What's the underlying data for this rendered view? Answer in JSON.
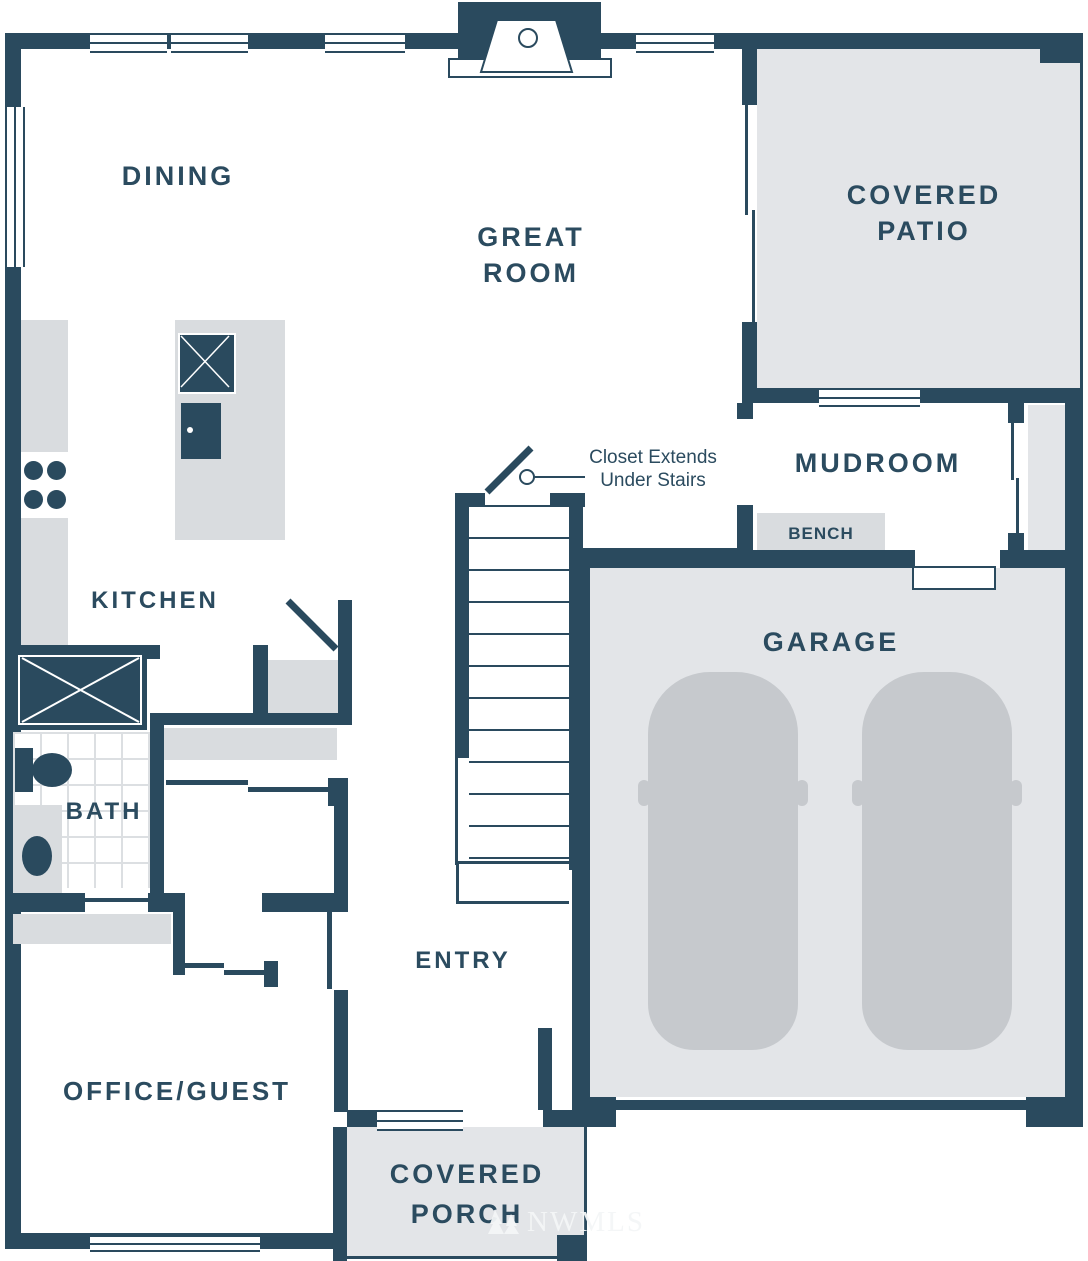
{
  "plan": {
    "rooms": {
      "dining": "DINING",
      "great_room_line1": "GREAT",
      "great_room_line2": "ROOM",
      "covered_patio_line1": "COVERED",
      "covered_patio_line2": "PATIO",
      "mudroom": "MUDROOM",
      "bench": "BENCH",
      "garage": "GARAGE",
      "kitchen": "KITCHEN",
      "bath": "BATH",
      "entry": "ENTRY",
      "office_guest": "OFFICE/GUEST",
      "covered_porch_line1": "COVERED",
      "covered_porch_line2": "PORCH"
    },
    "annotations": {
      "closet_line1": "Closet Extends",
      "closet_line2": "Under Stairs"
    },
    "watermark": "NWMLS",
    "colors": {
      "wall": "#2A4A5E",
      "floor_gray": "#E3E5E8",
      "counter_gray": "#D9DCDF",
      "car_gray": "#C6C9CD",
      "tile_line": "#DCDFE2"
    },
    "fixtures": [
      "fireplace",
      "window",
      "sliding-glass-door",
      "kitchen-island",
      "island-sink",
      "dishwasher",
      "cooktop",
      "pantry-shelves",
      "closet-shelf",
      "shower",
      "toilet",
      "vanity-sink",
      "staircase",
      "under-stair-closet-door",
      "bench",
      "car",
      "car",
      "garage-door",
      "front-door",
      "porch"
    ]
  }
}
